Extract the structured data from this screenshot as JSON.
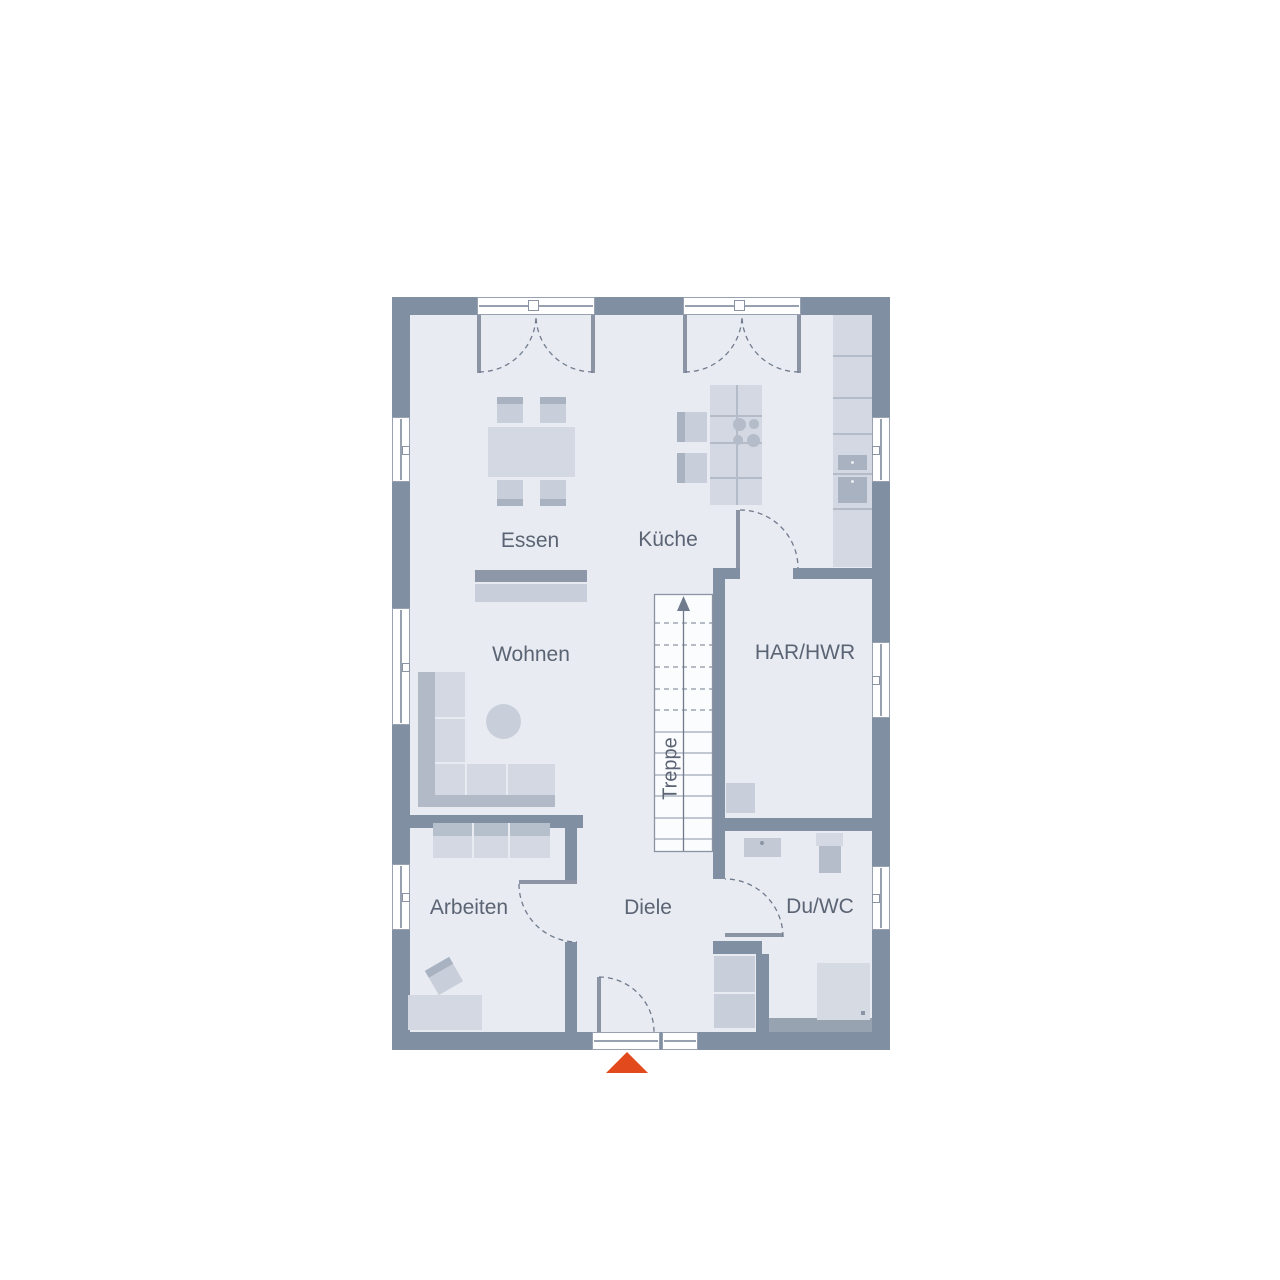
{
  "plan": {
    "rooms": {
      "essen": {
        "label": "Essen"
      },
      "kueche": {
        "label": "Küche"
      },
      "wohnen": {
        "label": "Wohnen"
      },
      "har_hwr": {
        "label": "HAR/HWR"
      },
      "treppe": {
        "label": "Treppe"
      },
      "arbeiten": {
        "label": "Arbeiten"
      },
      "diele": {
        "label": "Diele"
      },
      "du_wc": {
        "label": "Du/WC"
      }
    },
    "colors": {
      "wall": "#8090a2",
      "floor": "#e8ebf1",
      "window": "#ffffff",
      "furniture_light": "#d3d8e2",
      "furniture_mid": "#c9cfda",
      "furniture_dark": "#a9b2c1",
      "accent_strip": "#8d97a8",
      "line": "#8a94a5",
      "line_dark": "#707b8d",
      "text": "#5b6474",
      "entrance_marker": "#e2491d",
      "stairs_fill": "#fbfcfd"
    }
  }
}
